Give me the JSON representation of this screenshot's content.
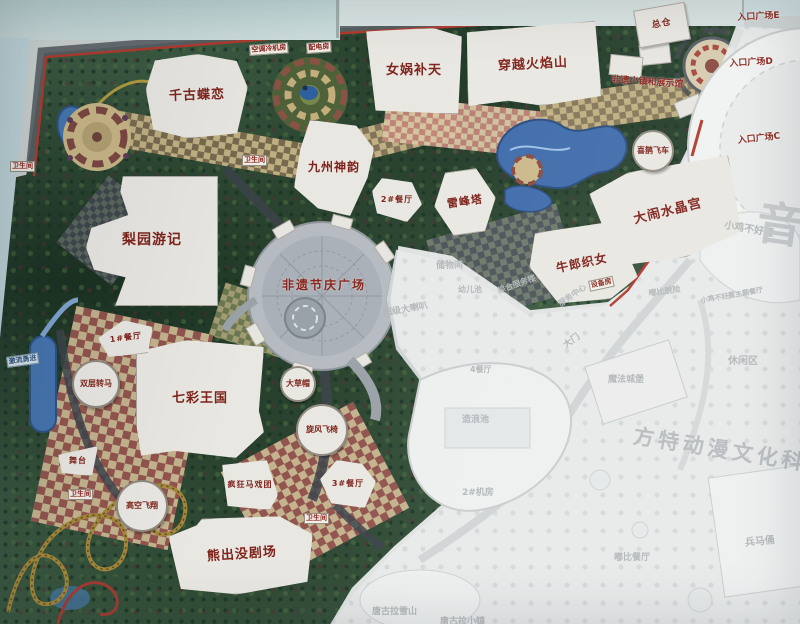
{
  "map": {
    "title": "theme-park-masterplan-board-photo",
    "buildings": [
      {
        "id": "qiangu-dielian",
        "label": "千古蝶恋",
        "x": 146,
        "y": 54,
        "w": 102,
        "h": 84,
        "rot": -2,
        "fs": 13,
        "clip": "polygon(10% 6%,52% 0,90% 10%,100% 42%,88% 96%,40% 100%,6% 88%,0 40%)"
      },
      {
        "id": "nuwa-butian",
        "label": "女娲补天",
        "x": 366,
        "y": 28,
        "w": 96,
        "h": 86,
        "rot": 0,
        "fs": 13,
        "clip": "polygon(0 4%,70% 0,100% 10%,96% 100%,10% 96%)"
      },
      {
        "id": "chuanyue-huoyanshan",
        "label": "穿越火焰山",
        "x": 466,
        "y": 24,
        "w": 134,
        "h": 82,
        "rot": -3,
        "fs": 13,
        "clip": "polygon(2% 6%,98% 0,100% 92%,55% 100%,30% 92%,0 96%)"
      },
      {
        "id": "zongcang",
        "label": "总仓",
        "x": 636,
        "y": 6,
        "w": 52,
        "h": 38,
        "rot": -10,
        "fs": 9,
        "clip": ""
      },
      {
        "id": "jiuzhou-shenyun",
        "label": "九州神韵",
        "x": 294,
        "y": 120,
        "w": 80,
        "h": 96,
        "rot": 0,
        "fs": 12,
        "clip": "polygon(20% 0,78% 6%,100% 30%,92% 60%,70% 100%,30% 92%,0 70%,8% 30%)"
      },
      {
        "id": "leifeng-ta",
        "label": "雷峰塔",
        "x": 434,
        "y": 170,
        "w": 62,
        "h": 64,
        "rot": -8,
        "fs": 11,
        "clip": "polygon(25% 0,75% 0,100% 50%,75% 100%,25% 100%,0 50%)"
      },
      {
        "id": "danao-shuijinggong",
        "label": "大闹水晶宫",
        "x": 596,
        "y": 164,
        "w": 144,
        "h": 96,
        "rot": -14,
        "fs": 13,
        "clip": "polygon(0 12%,30% 0,100% 8%,96% 88%,55% 100%,8% 92%)"
      },
      {
        "id": "niulang-zhinv",
        "label": "牛郎织女",
        "x": 530,
        "y": 224,
        "w": 104,
        "h": 80,
        "rot": -12,
        "fs": 12,
        "clip": "polygon(12% 0,88% 6%,100% 80%,70% 100%,20% 92%,0 40%)"
      },
      {
        "id": "liyuan-youji",
        "label": "梨园游记",
        "x": 86,
        "y": 176,
        "w": 132,
        "h": 130,
        "rot": 0,
        "fs": 14,
        "clip": "polygon(28% 0,100% 0,100% 100%,22% 100%,30% 78%,6% 72%,0 55%,4% 40%,32% 30%,26% 12%)"
      },
      {
        "id": "qicai-wangguo",
        "label": "七彩王国",
        "x": 136,
        "y": 340,
        "w": 128,
        "h": 118,
        "rot": 0,
        "fs": 13,
        "clip": "polygon(0 10%,40% 0,100% 6%,96% 60%,100% 78%,78% 100%,30% 94%,4% 98%,0 70%)"
      },
      {
        "id": "xiongchumo-juchang",
        "label": "熊出没剧场",
        "x": 170,
        "y": 516,
        "w": 144,
        "h": 78,
        "rot": -4,
        "fs": 13,
        "clip": "polygon(0 20%,20% 8%,24% 0,78% 4%,100% 30%,94% 90%,45% 100%,6% 88%)"
      },
      {
        "id": "canteen-1",
        "label": "1#餐厅",
        "x": 98,
        "y": 320,
        "w": 56,
        "h": 36,
        "rot": -8,
        "fs": 8,
        "clip": "polygon(0 40%,50% 0,100% 30%,85% 100%,15% 95%)"
      },
      {
        "id": "canteen-2",
        "label": "2#餐厅",
        "x": 372,
        "y": 178,
        "w": 50,
        "h": 44,
        "rot": 0,
        "fs": 8,
        "clip": "polygon(20% 0,80% 10%,100% 60%,70% 100%,10% 80%,0 30%)"
      },
      {
        "id": "canteen-3",
        "label": "3#餐厅",
        "x": 320,
        "y": 460,
        "w": 56,
        "h": 48,
        "rot": 0,
        "fs": 8,
        "clip": "polygon(30% 0,75% 8%,100% 45%,80% 100%,20% 90%,0 40%)"
      },
      {
        "id": "fengkuang-maxituan",
        "label": "疯狂马戏团",
        "x": 222,
        "y": 460,
        "w": 56,
        "h": 50,
        "rot": 0,
        "fs": 8,
        "clip": "polygon(0 10%,80% 0,100% 70%,85% 100%,10% 92%)"
      },
      {
        "id": "wutai",
        "label": "舞台",
        "x": 58,
        "y": 446,
        "w": 40,
        "h": 30,
        "rot": 0,
        "fs": 8,
        "clip": "polygon(0 30%,100% 0,85% 100%,10% 90%)"
      }
    ],
    "circles": [
      {
        "id": "shuangceng-zhuanma",
        "label": "双层转马",
        "x": 72,
        "y": 360,
        "d": 48,
        "fs": 8
      },
      {
        "id": "dacaomao",
        "label": "大草帽",
        "x": 280,
        "y": 366,
        "d": 36,
        "fs": 8
      },
      {
        "id": "xuanfeng-feiyi",
        "label": "旋风飞椅",
        "x": 296,
        "y": 404,
        "d": 52,
        "fs": 8
      },
      {
        "id": "gaokong-feixiang",
        "label": "高空飞翔",
        "x": 116,
        "y": 480,
        "d": 52,
        "fs": 8
      },
      {
        "id": "xique-feiche",
        "label": "喜鹊飞车",
        "x": 632,
        "y": 130,
        "d": 42,
        "fs": 8
      }
    ],
    "labels": [
      {
        "id": "toilet-1",
        "t": "卫生间",
        "x": 10,
        "y": 161,
        "cls": "chip"
      },
      {
        "id": "toilet-2",
        "t": "卫生间",
        "x": 242,
        "y": 155,
        "cls": "chip"
      },
      {
        "id": "toilet-3",
        "t": "卫生间",
        "x": 68,
        "y": 489,
        "cls": "chip"
      },
      {
        "id": "toilet-4",
        "t": "卫生间",
        "x": 304,
        "y": 513,
        "cls": "chip"
      },
      {
        "id": "chiller-room",
        "t": "空调冷机房",
        "x": 249,
        "y": 45,
        "cls": "chip",
        "rot": -4
      },
      {
        "id": "power-room",
        "t": "配电房",
        "x": 306,
        "y": 43,
        "cls": "chip",
        "rot": -4
      },
      {
        "id": "equipment-room",
        "t": "设备房",
        "x": 588,
        "y": 281,
        "cls": "chip",
        "rot": -12
      },
      {
        "id": "jiliu-yongjin",
        "t": "激流勇进",
        "x": 6,
        "y": 357,
        "cls": "chip-blue",
        "rot": -8
      },
      {
        "id": "heritage-town-hall",
        "t": "非遗小镇和展示馆",
        "x": 612,
        "y": 72,
        "cls": "red",
        "rot": 4
      },
      {
        "id": "entrance-plaza-e",
        "t": "入口广场E",
        "x": 737,
        "y": 10,
        "cls": "red",
        "rot": -3
      },
      {
        "id": "entrance-plaza-d",
        "t": "入口广场D",
        "x": 729,
        "y": 56,
        "cls": "red",
        "rot": -3
      },
      {
        "id": "entrance-plaza-c",
        "t": "入口广场C",
        "x": 737,
        "y": 133,
        "cls": "red",
        "rot": -6
      },
      {
        "id": "feiyi-festival-plaza",
        "t": "非遗节庆广场",
        "x": 282,
        "y": 276,
        "cls": "plaza",
        "fs": 12
      },
      {
        "id": "storage",
        "t": "储物间",
        "x": 436,
        "y": 258,
        "cls": "faded"
      },
      {
        "id": "kids-pool",
        "t": "幼儿池",
        "x": 458,
        "y": 284,
        "cls": "faded",
        "fs": 8
      },
      {
        "id": "service-building",
        "t": "综合服务楼",
        "x": 496,
        "y": 286,
        "cls": "faded",
        "fs": 8,
        "rot": -20
      },
      {
        "id": "super-horn-slide",
        "t": "超级大喇叭",
        "x": 382,
        "y": 306,
        "cls": "faded",
        "rot": -10
      },
      {
        "id": "wave-pool",
        "t": "造浪池",
        "x": 462,
        "y": 412,
        "cls": "faded"
      },
      {
        "id": "machine-room-2",
        "t": "2#机房",
        "x": 462,
        "y": 485,
        "cls": "faded"
      },
      {
        "id": "canteen-4",
        "t": "4餐厅",
        "x": 470,
        "y": 364,
        "cls": "faded",
        "fs": 8
      },
      {
        "id": "service-center",
        "t": "服务中心",
        "x": 556,
        "y": 300,
        "cls": "faded",
        "fs": 8,
        "rot": -35
      },
      {
        "id": "gate",
        "t": "大门",
        "x": 560,
        "y": 340,
        "cls": "faded",
        "rot": -35
      },
      {
        "id": "magic-castle",
        "t": "魔法城堡",
        "x": 608,
        "y": 372,
        "cls": "faded"
      },
      {
        "id": "dubi-escape",
        "t": "嘟比脱险",
        "x": 648,
        "y": 288,
        "cls": "faded",
        "fs": 8,
        "rot": -8
      },
      {
        "id": "dubi-restaurant",
        "t": "嘟比餐厅",
        "x": 614,
        "y": 550,
        "cls": "faded"
      },
      {
        "id": "terracotta",
        "t": "兵马俑",
        "x": 744,
        "y": 534,
        "cls": "faded",
        "fs": 10,
        "rot": -6
      },
      {
        "id": "leisure-area",
        "t": "休闲区",
        "x": 728,
        "y": 352,
        "cls": "faded",
        "fs": 10
      },
      {
        "id": "chicken-ride",
        "t": "小鸡不好惹",
        "x": 726,
        "y": 216,
        "cls": "faded",
        "fs": 10,
        "rot": 10
      },
      {
        "id": "chicken-restaurant",
        "t": "小鸡不好惹主题餐厅",
        "x": 700,
        "y": 296,
        "cls": "faded",
        "fs": 7,
        "rot": -10
      },
      {
        "id": "tanggula-snow-mountain",
        "t": "唐古拉雪山",
        "x": 372,
        "y": 604,
        "cls": "faded"
      },
      {
        "id": "tanggula-town",
        "t": "唐古拉小镇",
        "x": 440,
        "y": 614,
        "cls": "faded"
      },
      {
        "id": "watermark-park-name",
        "t": "方特动漫文化科技园",
        "x": 636,
        "y": 420,
        "cls": "wm",
        "fs": 21,
        "rot": 9
      },
      {
        "id": "watermark-music",
        "t": "音乐",
        "x": 762,
        "y": 186,
        "cls": "wm-big",
        "fs": 46,
        "rot": 8
      }
    ]
  }
}
